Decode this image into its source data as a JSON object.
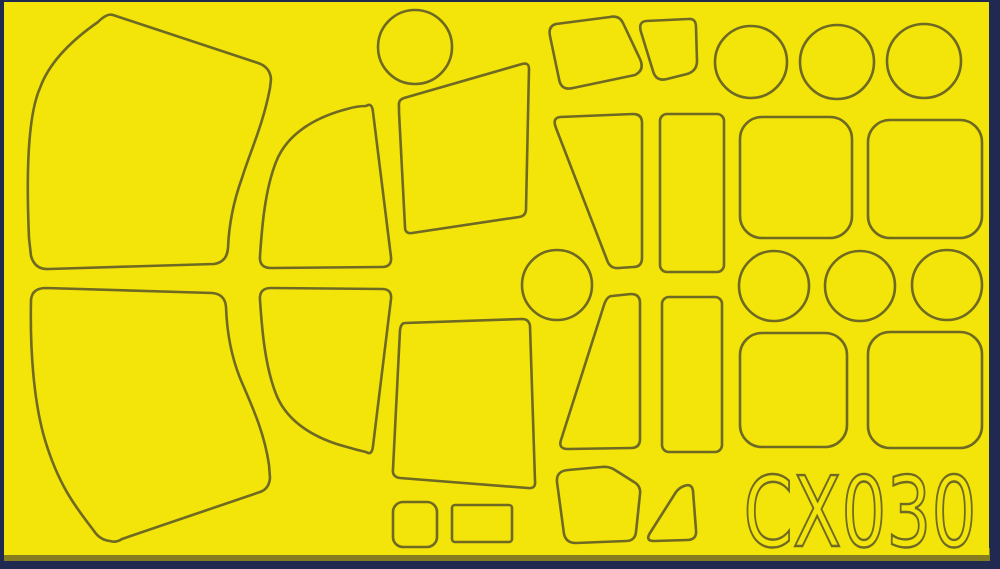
{
  "sheet": {
    "product_code": "CX030",
    "description": "die-cut yellow tape paint mask sheet with scribed cut outlines",
    "colors": {
      "tape": "#F3E40A",
      "cut_line": "#6E6923",
      "border": "#202A50",
      "bottom_strip": "#857D20"
    },
    "pieces": [
      {
        "name": "large-canopy-panel-upper-left",
        "d": "M113,15 L258,63 Q270,67 271,79 L270,88 C263,125 250,152 242,178 C234,200 229,222 228,248 Q227,262 214,264 L49,269 Q35,270 31,256 L29,238 C26,170 28,115 40,88 C50,60 75,38 98,22 Q107,13 113,15 Z"
      },
      {
        "name": "curved-quarter-panel-upper",
        "d": "M366,106 Q372,102 373,112 L391,257 Q392,267 382,267 L271,268 Q259,268 260,256 C262,226 265,190 276,162 C288,131 320,116 347,109 Q357,106 366,106 Z"
      },
      {
        "name": "trapezoid-panel-upper-center",
        "d": "M399,106 Q398,100 404,98 L522,64 Q529,62 529,69 L526,209 Q526,216 519,217 L412,233 Q405,234 405,227 L399,112 Z"
      },
      {
        "name": "disc-upper-center",
        "shape": "circle",
        "cx": 415,
        "cy": 47,
        "r": 37
      },
      {
        "name": "rhomboid-panel-upper",
        "d": "M556,24 L610,17 Q619,15 623,23 L640,59 Q645,70 635,75 L573,88 Q561,91 559,79 L550,36 Q548,26 556,24 Z"
      },
      {
        "name": "small-rhomboid-panel-upper",
        "d": "M646,21 L688,19 Q696,18 696,27 L697,61 Q697,71 687,74 L667,79 Q656,82 653,71 L641,32 Q638,22 646,21 Z"
      },
      {
        "name": "disc-upper-right-1",
        "shape": "circle",
        "cx": 751,
        "cy": 62,
        "r": 36
      },
      {
        "name": "disc-upper-right-2",
        "shape": "circle",
        "cx": 837,
        "cy": 62,
        "r": 37
      },
      {
        "name": "disc-upper-right-3",
        "shape": "circle",
        "cx": 924,
        "cy": 61,
        "r": 37
      },
      {
        "name": "wedge-panel-upper",
        "d": "M560,117 L633,114 Q642,114 642,123 L642,258 Q642,267 633,267 L619,268 Q610,269 607,260 L556,128 Q552,118 560,117 Z"
      },
      {
        "name": "tall-rect-panel-upper",
        "shape": "rect",
        "x": 660,
        "y": 114,
        "w": 64,
        "h": 158,
        "rx": 7
      },
      {
        "name": "rounded-square-panel-upper-1",
        "shape": "rect",
        "x": 740,
        "y": 117,
        "w": 112,
        "h": 121,
        "rx": 22
      },
      {
        "name": "rounded-square-panel-upper-2",
        "shape": "rect",
        "x": 868,
        "y": 120,
        "w": 114,
        "h": 118,
        "rx": 22
      },
      {
        "name": "disc-middle-center",
        "shape": "circle",
        "cx": 557,
        "cy": 285,
        "r": 35
      },
      {
        "name": "disc-middle-right-1",
        "shape": "circle",
        "cx": 774,
        "cy": 286,
        "r": 35
      },
      {
        "name": "disc-middle-right-2",
        "shape": "circle",
        "cx": 860,
        "cy": 286,
        "r": 35
      },
      {
        "name": "disc-middle-right-3",
        "shape": "circle",
        "cx": 947,
        "cy": 285,
        "r": 35
      },
      {
        "name": "large-canopy-panel-lower-left",
        "d": "M110,541 Q100,540 94,531 C80,512 60,490 45,440 C33,400 30,345 31,300 Q32,288 46,288 L212,293 Q225,294 226,307 C227,335 232,358 240,378 C250,402 264,430 269,465 L270,478 Q269,489 260,492 L122,539 Q116,543 110,541 Z"
      },
      {
        "name": "curved-quarter-panel-lower",
        "d": "M366,452 Q372,456 373,446 L391,299 Q392,289 382,289 L271,288 Q259,288 260,300 C262,330 265,366 276,394 C288,425 320,440 347,447 Q357,450 366,452 Z"
      },
      {
        "name": "trapezoid-panel-lower-center",
        "d": "M405,323 L522,319 Q529,319 530,326 L535,481 Q536,489 528,488 L400,478 Q392,477 393,469 L400,330 Q401,323 405,323 Z"
      },
      {
        "name": "wedge-panel-lower",
        "d": "M612,296 L631,294 Q640,294 640,303 L640,439 Q640,448 631,448 L568,449 Q558,449 561,440 L604,305 Q607,296 612,296 Z"
      },
      {
        "name": "tall-rect-panel-lower",
        "shape": "rect",
        "x": 662,
        "y": 297,
        "w": 60,
        "h": 155,
        "rx": 7
      },
      {
        "name": "rounded-square-panel-lower-1",
        "shape": "rect",
        "x": 740,
        "y": 333,
        "w": 107,
        "h": 114,
        "rx": 22
      },
      {
        "name": "rounded-square-panel-lower-2",
        "shape": "rect",
        "x": 868,
        "y": 332,
        "w": 114,
        "h": 116,
        "rx": 22
      },
      {
        "name": "small-square-panel-lower",
        "shape": "rect",
        "x": 393,
        "y": 502,
        "w": 44,
        "h": 45,
        "rx": 10
      },
      {
        "name": "small-rect-panel-lower",
        "shape": "rect",
        "x": 452,
        "y": 505,
        "w": 60,
        "h": 37,
        "rx": 3
      },
      {
        "name": "rounded-quad-panel-lower",
        "d": "M568,470 L601,467 Q609,466 615,470 L634,482 Q641,486 640,494 L636,532 Q635,541 626,541 L576,543 Q566,543 564,534 L557,482 Q556,471 568,470 Z"
      },
      {
        "name": "small-triangle-panel-lower",
        "d": "M684,486 Q692,483 693,491 L696,530 Q697,540 687,540 L654,541 Q645,541 650,533 L676,492 Q679,488 684,486 Z"
      }
    ]
  }
}
